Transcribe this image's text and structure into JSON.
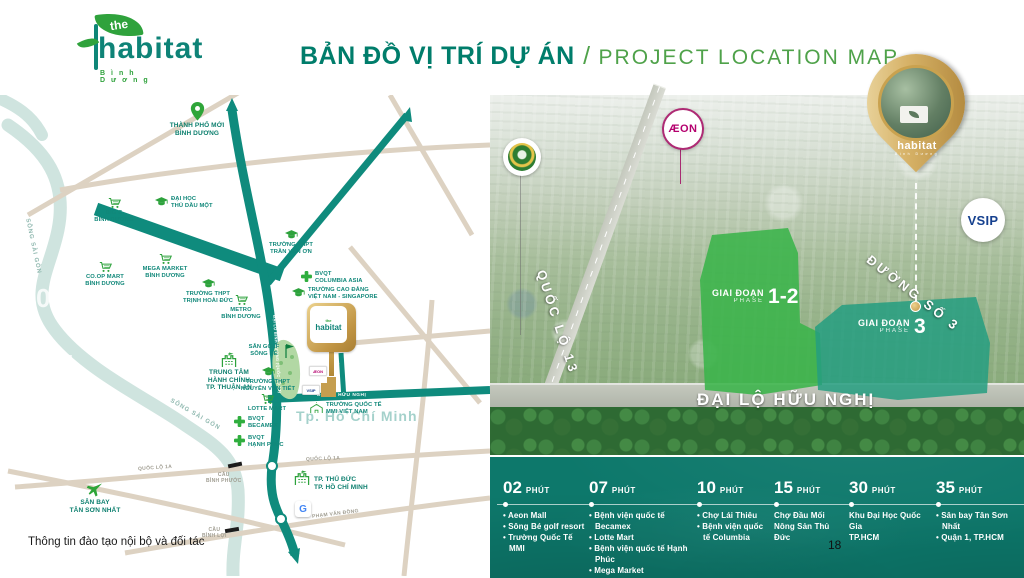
{
  "header": {
    "logo": {
      "pre": "the",
      "name": "habitat",
      "subtitle": "Bình Dương"
    },
    "title": {
      "vi": "BẢN ĐỒ VỊ TRÍ DỰ ÁN",
      "sep": "/",
      "en": "PROJECT LOCATION MAP"
    }
  },
  "map": {
    "pois": [
      {
        "icon": "location-pin",
        "label": "THÀNH PHỐ MỚI\nBÌNH DƯƠNG"
      },
      {
        "icon": "graduation-cap",
        "label": "ĐẠI HỌC\nTHỦ DẦU MỘT"
      },
      {
        "icon": "cart",
        "label": "BIG C\nBÌNH DƯƠNG"
      },
      {
        "icon": "cart",
        "label": "CO.OP MART\nBÌNH DƯƠNG"
      },
      {
        "icon": "cart",
        "label": "MEGA MARKET\nBÌNH DƯƠNG"
      },
      {
        "icon": "graduation-cap",
        "label": "TRƯỜNG THPT\nTRỊNH HOÀI ĐỨC"
      },
      {
        "icon": "cart",
        "label": "METRO\nBÌNH DƯƠNG"
      },
      {
        "icon": "graduation-cap",
        "label": "TRƯỜNG THPT\nTRẦN VĂN ƠN"
      },
      {
        "icon": "medical-cross",
        "label": "BVQT\nCOLUMBIA ASIA"
      },
      {
        "icon": "graduation-cap",
        "label": "TRƯỜNG CAO ĐẲNG\nVIỆT NAM - SINGAPORE"
      },
      {
        "icon": "golf-flag",
        "label": "SÂN GOLF\nSÔNG BÉ"
      },
      {
        "icon": "building",
        "label": "TRUNG TÂM\nHÀNH CHÍNH\nTP. THUẬN AN"
      },
      {
        "icon": "graduation-cap",
        "label": "TRƯỜNG THPT\nNGUYỄN VĂN TIẾT"
      },
      {
        "icon": "cart",
        "label": "LOTTE MART"
      },
      {
        "icon": "medical-cross",
        "label": "BVQT\nBECAMEX"
      },
      {
        "icon": "medical-cross",
        "label": "BVQT\nHẠNH PHÚC"
      },
      {
        "icon": "airplane",
        "label": "SÂN BAY\nTÂN SƠN NHẤT"
      },
      {
        "icon": "building",
        "label": "TP. THỦ ĐỨC\nTP. HỒ CHÍ MINH"
      },
      {
        "icon": "school",
        "label": "TRƯỜNG QUỐC TẾ\nMMI VIỆT NAM"
      }
    ],
    "roads": {
      "dai_lo_binh_duong": "ĐẠI LỘ BÌNH DƯƠNG (QUỐC LỘ 13)",
      "my_phuoc_tan_van": "MỸ PHƯỚC TÂN VẠN",
      "duong_so_3": "ĐƯỜNG SỐ 3",
      "dai_lo_huu_nghi": "ĐẠI LỘ HỮU NGHỊ",
      "quoc_lo_1a": "QUỐC LỘ 1A",
      "pham_van_dong": "PHẠM VĂN ĐỒNG",
      "cau_binh_phuoc": "CẦU\nBÌNH PHƯỚC",
      "cau_binh_loi": "CẦU\nBÌNH LỢI",
      "song_sai_gon": "SÔNG SÀI GÒN",
      "tp_hcm": "Tp. Hồ Chí Minh"
    },
    "badges": {
      "aeon": "ÆON",
      "vsip": "VSIP",
      "google": "G",
      "habitat": "habitat",
      "habitat_pre": "the"
    },
    "watermarks": {
      "w1": "02",
      "w2": "07"
    }
  },
  "photo": {
    "quoc_lo_13": "QUỐC LỘ 13",
    "duong_so_3": "ĐƯỜNG SỐ 3",
    "dai_lo_huu_nghi": "ĐẠI LỘ HỮU NGHỊ",
    "phase12": {
      "vi": "GIAI ĐOẠN",
      "en": "PHASE",
      "num": "1-2"
    },
    "phase3": {
      "vi": "GIAI ĐOẠN",
      "en": "PHASE",
      "num": "3"
    },
    "aeon": "ÆON",
    "vsip": "VSIP",
    "pin": {
      "name": "habitat",
      "subtitle": "Bình Dương"
    }
  },
  "panel": {
    "columns": [
      {
        "time": "02",
        "unit": "PHÚT",
        "items": [
          "Aeon Mall",
          "Sông Bé golf resort",
          "Trường Quốc Tế MMI"
        ]
      },
      {
        "time": "07",
        "unit": "PHÚT",
        "items": [
          "Bệnh viện quốc tế Becamex",
          "Lotte Mart",
          "Bệnh viện quốc tế Hạnh Phúc",
          "Mega Market"
        ]
      },
      {
        "time": "10",
        "unit": "PHÚT",
        "items": [
          "Chợ Lái Thiêu",
          "Bệnh viện quốc tế Columbia"
        ]
      },
      {
        "time": "15",
        "unit": "PHÚT",
        "items": [
          "Chợ Đầu Mối",
          "Nông Sản Thủ Đức"
        ]
      },
      {
        "time": "30",
        "unit": "PHÚT",
        "items": [
          "Khu Đại Học Quốc Gia",
          "TP.HCM"
        ]
      },
      {
        "time": "35",
        "unit": "PHÚT",
        "items": [
          "Sân bay Tân Sơn Nhất",
          "Quận 1, TP.HCM"
        ]
      }
    ]
  },
  "footer": {
    "note": "Thông tin đào tạo nội bộ và đối tác",
    "page": "18"
  }
}
